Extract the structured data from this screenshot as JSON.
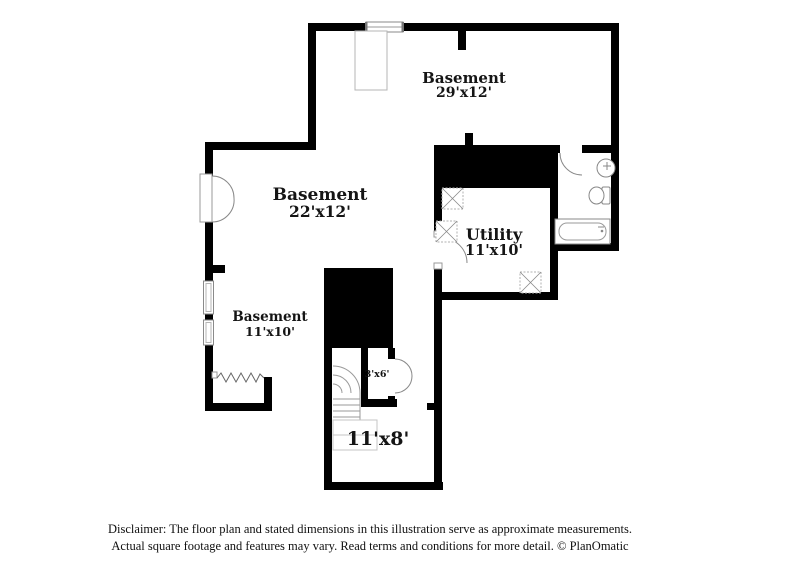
{
  "floor_plan": {
    "rooms": [
      {
        "name": "Basement",
        "dims": "29'x12'"
      },
      {
        "name": "Basement",
        "dims": "22'x12'"
      },
      {
        "name": "Basement",
        "dims": "11'x10'"
      },
      {
        "name": "Utility",
        "dims": "11'x10'"
      },
      {
        "name": "",
        "dims": "3'x6'"
      },
      {
        "name": "",
        "dims": "11'x8'"
      }
    ],
    "colors": {
      "wall": "#000000",
      "fixture_outline": "#8a8a8a",
      "background": "#ffffff",
      "text": "#151515"
    }
  },
  "disclaimer": {
    "line1": "Disclaimer: The floor plan and stated dimensions in this illustration serve as approximate measurements.",
    "line2": "Actual square footage and features may vary. Read terms and conditions for more detail. © PlanOmatic"
  }
}
